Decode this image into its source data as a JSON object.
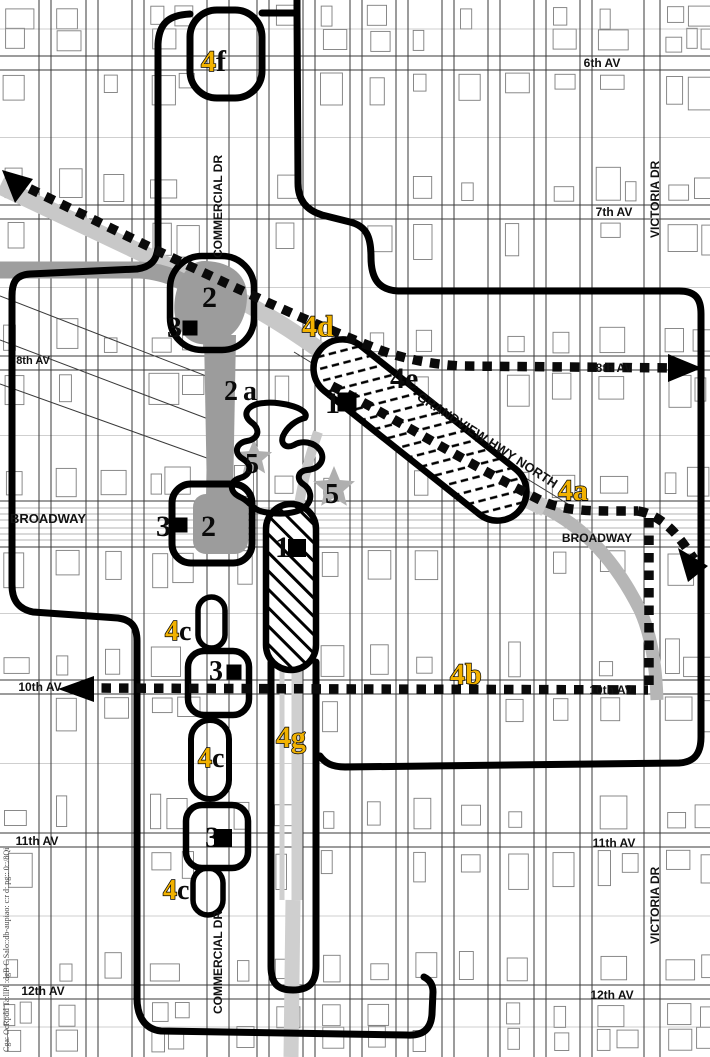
{
  "page": {
    "caption_vertical": "Cga: OcRpdd Ta:llPl :dgB C Salo::db-aupiao: c:r d: pg:: 0::/8Qi"
  },
  "colors": {
    "zone_label_yellow": "#F2B200",
    "zone_label_black": "#0a0a0a",
    "boundary_black": "#000000",
    "station_gray": "#9C9C9C",
    "cut_band_gray": "#C8C8C8",
    "mid_band_gray": "#9E9E9E",
    "corridor_gray": "#CFCFCF",
    "star_gray": "#AFAFAF"
  },
  "street_labels": [
    {
      "id": "6th-av-right",
      "text": "6th AV",
      "x": 602,
      "y": 67,
      "size": 12
    },
    {
      "id": "7th-av-right",
      "text": "7th AV",
      "x": 614,
      "y": 216,
      "size": 12
    },
    {
      "id": "8th-av-left",
      "text": "8th AV",
      "x": 33,
      "y": 364,
      "size": 11
    },
    {
      "id": "8th-av-right",
      "text": "8th AV",
      "x": 614,
      "y": 372,
      "size": 12
    },
    {
      "id": "broadway-left",
      "text": "BROADWAY",
      "x": 48,
      "y": 523,
      "size": 13
    },
    {
      "id": "broadway-right",
      "text": "BROADWAY",
      "x": 597,
      "y": 542,
      "size": 12
    },
    {
      "id": "10th-av-left",
      "text": "10th AV",
      "x": 40,
      "y": 691,
      "size": 12
    },
    {
      "id": "10th-av-right",
      "text": "10th AV",
      "x": 611,
      "y": 694,
      "size": 12
    },
    {
      "id": "11th-av-left",
      "text": "11th AV",
      "x": 37,
      "y": 845,
      "size": 12
    },
    {
      "id": "11th-av-right",
      "text": "11th AV",
      "x": 614,
      "y": 847,
      "size": 12
    },
    {
      "id": "12th-av-left",
      "text": "12th AV",
      "x": 43,
      "y": 995,
      "size": 12
    },
    {
      "id": "12th-av-right",
      "text": "12th AV",
      "x": 612,
      "y": 999,
      "size": 12
    },
    {
      "id": "commercial-dr-top",
      "text": "COMMERCIAL DR",
      "x": 222,
      "y": 258,
      "rot": -90,
      "size": 12
    },
    {
      "id": "commercial-dr-bottom",
      "text": "COMMERCIAL DR",
      "x": 222,
      "y": 1014,
      "rot": -90,
      "size": 12
    },
    {
      "id": "victoria-dr-top",
      "text": "VICTORIA DR",
      "x": 659,
      "y": 238,
      "rot": -90,
      "size": 12
    },
    {
      "id": "victoria-dr-bottom",
      "text": "VICTORIA DR",
      "x": 659,
      "y": 944,
      "rot": -90,
      "size": 12
    },
    {
      "id": "grandview-hwy-north",
      "text": "GRANDVIEW HWY NORTH",
      "x": 416,
      "y": 399,
      "rot": 33,
      "size": 13
    }
  ],
  "zone_labels": [
    {
      "id": "4f",
      "x": 201,
      "y": 71,
      "size": 30,
      "parts": [
        {
          "t": "4",
          "c": "yellow"
        },
        {
          "t": "f",
          "c": "black"
        }
      ]
    },
    {
      "id": "2-grandview",
      "x": 202,
      "y": 307,
      "size": 30,
      "parts": [
        {
          "t": "2",
          "c": "black"
        }
      ]
    },
    {
      "id": "3-grandview",
      "x": 167,
      "y": 337,
      "size": 30,
      "parts": [
        {
          "t": "3",
          "c": "black"
        }
      ]
    },
    {
      "id": "4d",
      "x": 302,
      "y": 336,
      "size": 30,
      "parts": [
        {
          "t": "4",
          "c": "yellow"
        },
        {
          "t": "d",
          "c": "yellow"
        }
      ]
    },
    {
      "id": "2a",
      "x": 224,
      "y": 400,
      "size": 28,
      "spacing": 5,
      "parts": [
        {
          "t": "2",
          "c": "black"
        },
        {
          "t": "a",
          "c": "black"
        }
      ]
    },
    {
      "id": "4e",
      "x": 390,
      "y": 388,
      "size": 30,
      "parts": [
        {
          "t": "4",
          "c": "black"
        },
        {
          "t": "e",
          "c": "black"
        }
      ]
    },
    {
      "id": "1-grandview",
      "x": 325,
      "y": 413,
      "size": 30,
      "parts": [
        {
          "t": "1",
          "c": "black"
        }
      ]
    },
    {
      "id": "5-west",
      "x": 245,
      "y": 473,
      "size": 28,
      "parts": [
        {
          "t": "5",
          "c": "black"
        }
      ]
    },
    {
      "id": "5-east",
      "x": 325,
      "y": 503,
      "size": 28,
      "parts": [
        {
          "t": "5",
          "c": "black"
        }
      ]
    },
    {
      "id": "4a",
      "x": 558,
      "y": 500,
      "size": 30,
      "parts": [
        {
          "t": "4",
          "c": "yellow"
        },
        {
          "t": "a",
          "c": "yellow"
        }
      ]
    },
    {
      "id": "3-broadway",
      "x": 156,
      "y": 536,
      "size": 30,
      "parts": [
        {
          "t": "3",
          "c": "black"
        }
      ]
    },
    {
      "id": "2-broadway",
      "x": 201,
      "y": 536,
      "size": 30,
      "parts": [
        {
          "t": "2",
          "c": "black"
        }
      ]
    },
    {
      "id": "1-broadway",
      "x": 275,
      "y": 557,
      "size": 30,
      "parts": [
        {
          "t": "1",
          "c": "black"
        }
      ]
    },
    {
      "id": "4c-north",
      "x": 165,
      "y": 640,
      "size": 28,
      "parts": [
        {
          "t": "4",
          "c": "yellow"
        },
        {
          "t": "c",
          "c": "black"
        }
      ]
    },
    {
      "id": "3-10th",
      "x": 209,
      "y": 680,
      "size": 28,
      "parts": [
        {
          "t": "3",
          "c": "black"
        }
      ]
    },
    {
      "id": "4b",
      "x": 450,
      "y": 684,
      "size": 30,
      "parts": [
        {
          "t": "4",
          "c": "yellow"
        },
        {
          "t": "b",
          "c": "yellow"
        }
      ]
    },
    {
      "id": "4g",
      "x": 276,
      "y": 747,
      "size": 30,
      "parts": [
        {
          "t": "4",
          "c": "yellow"
        },
        {
          "t": "g",
          "c": "yellow"
        }
      ]
    },
    {
      "id": "4c-mid",
      "x": 198,
      "y": 767,
      "size": 28,
      "parts": [
        {
          "t": "4",
          "c": "yellow"
        },
        {
          "t": "c",
          "c": "black"
        }
      ]
    },
    {
      "id": "3-11th",
      "x": 205,
      "y": 847,
      "size": 30,
      "parts": [
        {
          "t": "3",
          "c": "black"
        }
      ]
    },
    {
      "id": "4c-south",
      "x": 163,
      "y": 899,
      "size": 28,
      "parts": [
        {
          "t": "4",
          "c": "yellow"
        },
        {
          "t": "c",
          "c": "black"
        }
      ]
    }
  ],
  "stations": [
    {
      "id": "station-grandview-3",
      "x": 190,
      "y": 328,
      "s": 15
    },
    {
      "id": "station-grandview-1",
      "x": 347,
      "y": 402,
      "s": 19
    },
    {
      "id": "station-broadway-3",
      "x": 180,
      "y": 525,
      "s": 15
    },
    {
      "id": "station-broadway-1",
      "x": 297,
      "y": 548,
      "s": 18
    },
    {
      "id": "station-10th-3",
      "x": 234,
      "y": 672,
      "s": 15
    },
    {
      "id": "station-11th-3",
      "x": 223,
      "y": 838,
      "s": 18
    }
  ],
  "stars": [
    {
      "id": "star-west",
      "x": 254,
      "y": 458,
      "r": 19
    },
    {
      "id": "star-east",
      "x": 334,
      "y": 488,
      "r": 22
    }
  ]
}
